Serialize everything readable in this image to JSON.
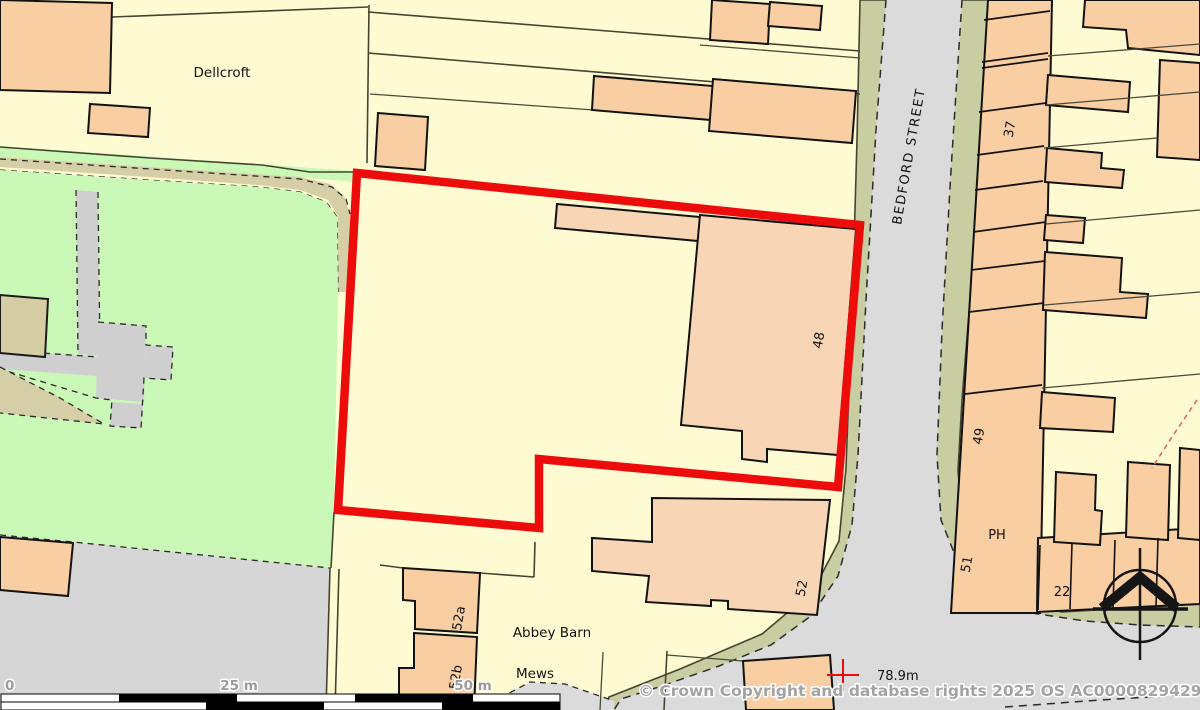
{
  "map_type": "ordnance-survey-extract",
  "labels": [
    {
      "text": "Dellcroft"
    },
    {
      "text": "BEDFORD STREET"
    },
    {
      "text": "37"
    },
    {
      "text": "48"
    },
    {
      "text": "52"
    },
    {
      "text": "49"
    },
    {
      "text": "PH"
    },
    {
      "text": "51"
    },
    {
      "text": "22"
    },
    {
      "text": "52a"
    },
    {
      "text": "52b"
    },
    {
      "text": "Abbey Barn"
    },
    {
      "text": "Mews"
    },
    {
      "text": "78.9m"
    }
  ],
  "scale_bar": {
    "zero": "0",
    "mid": "25 m",
    "end": "50 m"
  },
  "copyright": {
    "text": "© Crown Copyright and database rights 2025 OS AC0000829429"
  },
  "colors": {
    "land": "#fefbd2",
    "building": "#f8cea2",
    "building_light": "#f8d5b4",
    "green_space": "#caf8b7",
    "road_surface": "#dbdbdb",
    "road_verge": "#c9cda2",
    "path_tan": "#d6cea6",
    "gray_feature": "#d2d2d2",
    "selection_red": "#ed0c0c"
  }
}
